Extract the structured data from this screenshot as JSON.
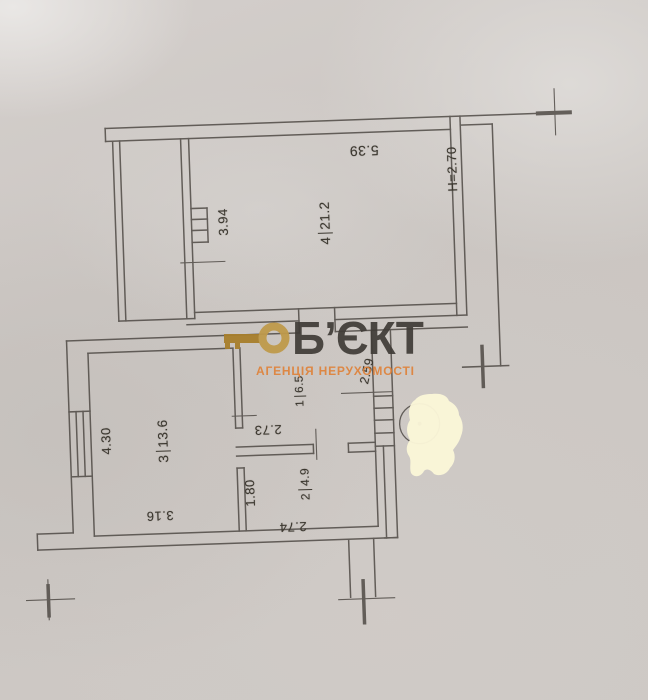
{
  "document": {
    "kind_label": "apartment floor plan (scanned)"
  },
  "watermark": {
    "brand": "Б’ЄКТ",
    "subtitle": "АГЕНЦІЯ НЕРУХОМОСТІ",
    "brand_color": "#403c37",
    "subtitle_color": "#e07f33",
    "key_color": "#b6913d"
  },
  "rooms": [
    {
      "number": "4",
      "area": "21.2"
    },
    {
      "number": "3",
      "area": "13.6"
    },
    {
      "number": "1",
      "area": "6.5"
    },
    {
      "number": "2",
      "area": "4.9"
    }
  ],
  "dimensions": {
    "room4_width": "5.39",
    "ceiling_height": "H=2.70",
    "shaft_side": "3.94",
    "room3_depth": "4.30",
    "room3_width": "3.16",
    "hall_width": "2.73",
    "room2_depth": "1.80",
    "room2_width": "2.74",
    "hall_diag": "2.59"
  },
  "colors": {
    "paper": "#ccc7c3",
    "line": "#4a4540",
    "ink": "#3b372f",
    "blob": "#faf6d8"
  }
}
